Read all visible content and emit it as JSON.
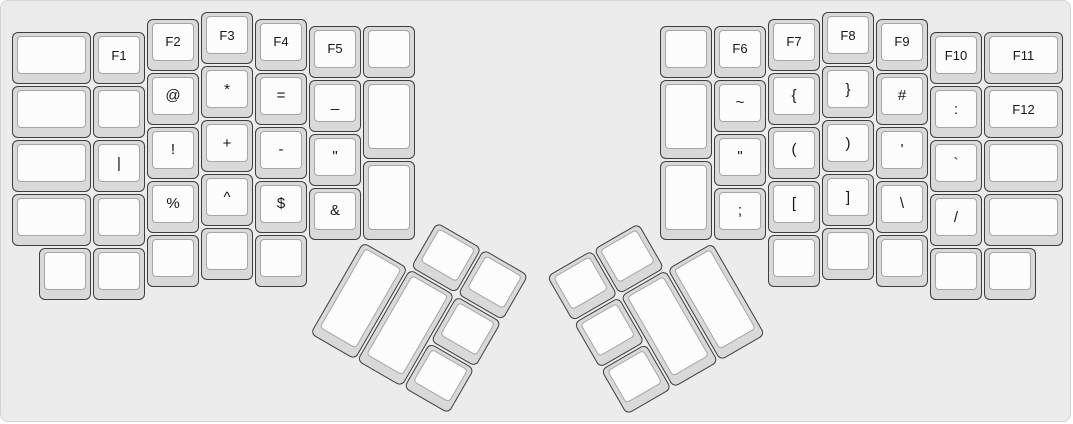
{
  "board": {
    "unit_px": 54,
    "offset_px": 10,
    "panel_bg": "#ececec",
    "panel_border": "#d4d4d4",
    "key_base_color": "#d9d9d9",
    "key_outline_color": "#3e3e3e",
    "key_top_color": "#fcfcfc",
    "key_top_border_color": "#a6a6a6",
    "label_color": "#161616"
  },
  "keys": [
    {
      "name": "blank",
      "x": 0,
      "y": 0.375,
      "w": 1.5
    },
    {
      "name": "f1",
      "label": "F1",
      "x": 1.5,
      "y": 0.375
    },
    {
      "name": "f2",
      "label": "F2",
      "x": 2.5,
      "y": 0.125
    },
    {
      "name": "f3",
      "label": "F3",
      "x": 3.5,
      "y": 0
    },
    {
      "name": "f4",
      "label": "F4",
      "x": 4.5,
      "y": 0.125
    },
    {
      "name": "f5",
      "label": "F5",
      "x": 5.5,
      "y": 0.25
    },
    {
      "name": "blank",
      "x": 6.5,
      "y": 0.25
    },
    {
      "name": "blank",
      "x": 0,
      "y": 1.375,
      "w": 1.5
    },
    {
      "name": "blank",
      "x": 1.5,
      "y": 1.375
    },
    {
      "name": "at",
      "label": "@",
      "x": 2.5,
      "y": 1.125
    },
    {
      "name": "asterisk",
      "label": "*",
      "x": 3.5,
      "y": 1
    },
    {
      "name": "equals",
      "label": "=",
      "x": 4.5,
      "y": 1.125
    },
    {
      "name": "underscore",
      "label": "_",
      "x": 5.5,
      "y": 1.25
    },
    {
      "name": "blank",
      "x": 6.5,
      "y": 1.25,
      "h": 1.5
    },
    {
      "name": "blank",
      "x": 0,
      "y": 2.375,
      "w": 1.5
    },
    {
      "name": "pipe",
      "label": "|",
      "x": 1.5,
      "y": 2.375
    },
    {
      "name": "exclamation",
      "label": "!",
      "x": 2.5,
      "y": 2.125
    },
    {
      "name": "plus",
      "label": "+",
      "x": 3.5,
      "y": 2
    },
    {
      "name": "minus",
      "label": "-",
      "x": 4.5,
      "y": 2.125
    },
    {
      "name": "double-quote",
      "label": "\"",
      "x": 5.5,
      "y": 2.25
    },
    {
      "name": "blank",
      "x": 0,
      "y": 3.375,
      "w": 1.5
    },
    {
      "name": "blank",
      "x": 1.5,
      "y": 3.375
    },
    {
      "name": "percent",
      "label": "%",
      "x": 2.5,
      "y": 3.125
    },
    {
      "name": "caret",
      "label": "^",
      "x": 3.5,
      "y": 3
    },
    {
      "name": "dollar",
      "label": "$",
      "x": 4.5,
      "y": 3.125
    },
    {
      "name": "ampersand",
      "label": "&",
      "x": 5.5,
      "y": 3.25
    },
    {
      "name": "blank",
      "x": 6.5,
      "y": 2.75,
      "h": 1.5
    },
    {
      "name": "blank",
      "x": 0.5,
      "y": 4.375
    },
    {
      "name": "blank",
      "x": 1.5,
      "y": 4.375
    },
    {
      "name": "blank",
      "x": 2.5,
      "y": 4.125
    },
    {
      "name": "blank",
      "x": 3.5,
      "y": 4
    },
    {
      "name": "blank",
      "x": 4.5,
      "y": 4.125
    },
    {
      "name": "thumb-blank",
      "x": 7.5,
      "y": 3.25,
      "r": 30,
      "rx": 6.5,
      "ry": 4.25
    },
    {
      "name": "thumb-blank",
      "x": 8.5,
      "y": 3.25,
      "r": 30,
      "rx": 6.5,
      "ry": 4.25
    },
    {
      "name": "thumb-blank",
      "x": 6.5,
      "y": 4.25,
      "h": 2,
      "r": 30,
      "rx": 6.5,
      "ry": 4.25
    },
    {
      "name": "thumb-blank",
      "x": 7.5,
      "y": 4.25,
      "h": 2,
      "r": 30,
      "rx": 6.5,
      "ry": 4.25
    },
    {
      "name": "thumb-blank",
      "x": 8.5,
      "y": 4.25,
      "r": 30,
      "rx": 6.5,
      "ry": 4.25
    },
    {
      "name": "thumb-blank",
      "x": 8.5,
      "y": 5.25,
      "r": 30,
      "rx": 6.5,
      "ry": 4.25
    },
    {
      "name": "blank",
      "x": 12,
      "y": 0.25
    },
    {
      "name": "f6",
      "label": "F6",
      "x": 13,
      "y": 0.25
    },
    {
      "name": "f7",
      "label": "F7",
      "x": 14,
      "y": 0.125
    },
    {
      "name": "f8",
      "label": "F8",
      "x": 15,
      "y": 0
    },
    {
      "name": "f9",
      "label": "F9",
      "x": 16,
      "y": 0.125
    },
    {
      "name": "f10",
      "label": "F10",
      "x": 17,
      "y": 0.375
    },
    {
      "name": "f11",
      "label": "F11",
      "x": 18,
      "y": 0.375,
      "w": 1.5
    },
    {
      "name": "blank",
      "x": 12,
      "y": 1.25,
      "h": 1.5
    },
    {
      "name": "tilde",
      "label": "~",
      "x": 13,
      "y": 1.25
    },
    {
      "name": "brace-open",
      "label": "{",
      "x": 14,
      "y": 1.125
    },
    {
      "name": "brace-close",
      "label": "}",
      "x": 15,
      "y": 1
    },
    {
      "name": "hash",
      "label": "#",
      "x": 16,
      "y": 1.125
    },
    {
      "name": "colon",
      "label": ":",
      "x": 17,
      "y": 1.375
    },
    {
      "name": "f12",
      "label": "F12",
      "x": 18,
      "y": 1.375,
      "w": 1.5
    },
    {
      "name": "double-quote",
      "label": "\"",
      "x": 13,
      "y": 2.25
    },
    {
      "name": "paren-open",
      "label": "(",
      "x": 14,
      "y": 2.125
    },
    {
      "name": "paren-close",
      "label": ")",
      "x": 15,
      "y": 2
    },
    {
      "name": "apostrophe",
      "label": "'",
      "x": 16,
      "y": 2.125
    },
    {
      "name": "backtick",
      "label": "`",
      "x": 17,
      "y": 2.375
    },
    {
      "name": "blank",
      "x": 18,
      "y": 2.375,
      "w": 1.5
    },
    {
      "name": "blank",
      "x": 12,
      "y": 2.75,
      "h": 1.5
    },
    {
      "name": "semicolon",
      "label": ";",
      "x": 13,
      "y": 3.25
    },
    {
      "name": "bracket-open",
      "label": "[",
      "x": 14,
      "y": 3.125
    },
    {
      "name": "bracket-close",
      "label": "]",
      "x": 15,
      "y": 3
    },
    {
      "name": "backslash",
      "label": "\\",
      "x": 16,
      "y": 3.125
    },
    {
      "name": "slash",
      "label": "/",
      "x": 17,
      "y": 3.375
    },
    {
      "name": "blank",
      "x": 18,
      "y": 3.375,
      "w": 1.5
    },
    {
      "name": "blank",
      "x": 14,
      "y": 4.125
    },
    {
      "name": "blank",
      "x": 15,
      "y": 4
    },
    {
      "name": "blank",
      "x": 16,
      "y": 4.125
    },
    {
      "name": "blank",
      "x": 17,
      "y": 4.375
    },
    {
      "name": "blank",
      "x": 18,
      "y": 4.375
    },
    {
      "name": "thumb-blank",
      "x": 10,
      "y": 3.25,
      "r": -30,
      "rx": 13,
      "ry": 4.25
    },
    {
      "name": "thumb-blank",
      "x": 11,
      "y": 3.25,
      "r": -30,
      "rx": 13,
      "ry": 4.25
    },
    {
      "name": "thumb-blank",
      "x": 10,
      "y": 4.25,
      "r": -30,
      "rx": 13,
      "ry": 4.25
    },
    {
      "name": "thumb-blank",
      "x": 11,
      "y": 4.25,
      "h": 2,
      "r": -30,
      "rx": 13,
      "ry": 4.25
    },
    {
      "name": "thumb-blank",
      "x": 12,
      "y": 4.25,
      "h": 2,
      "r": -30,
      "rx": 13,
      "ry": 4.25
    },
    {
      "name": "thumb-blank",
      "x": 10,
      "y": 5.25,
      "r": -30,
      "rx": 13,
      "ry": 4.25
    }
  ]
}
